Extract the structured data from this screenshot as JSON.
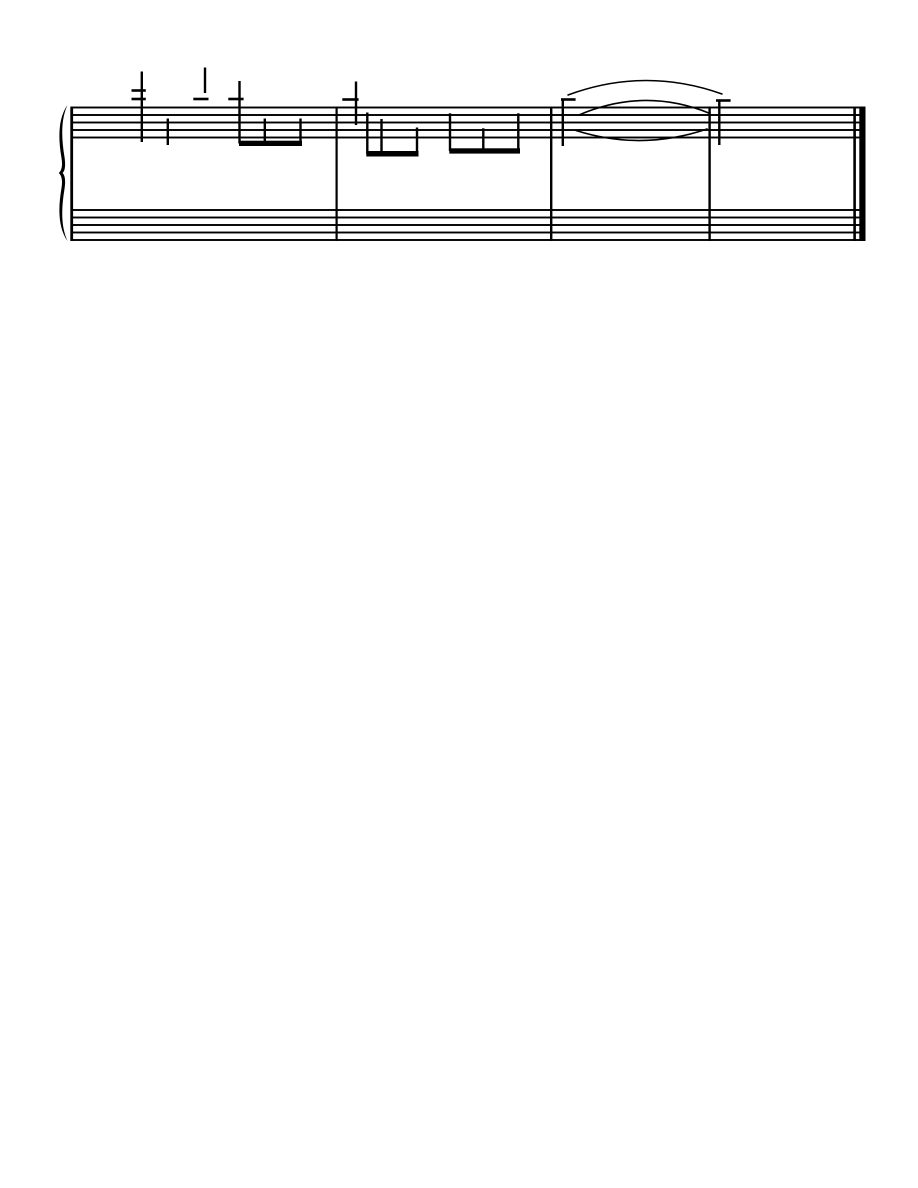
{
  "page": {
    "width": 918,
    "height": 1188,
    "background_color": "#ffffff",
    "ink_color": "#000000"
  },
  "system": {
    "staves": [
      {
        "name": "treble",
        "top": 107.5,
        "line_spacing": 7.5,
        "line_count": 5,
        "x1": 71,
        "x2": 865.5,
        "line_thickness": 1.9
      },
      {
        "name": "bass",
        "top": 210.0,
        "line_spacing": 7.5,
        "line_count": 5,
        "x1": 71,
        "x2": 865.5,
        "line_thickness": 1.9
      }
    ],
    "brace": {
      "path": "M 67.5 105 C 59 117, 57.5 135, 61.5 158 C 62.6 165, 62 170, 58.8 173 C 62 176, 62.6 181, 61.5 188 C 57.5 211, 59 229, 67.5 241 C 61.5 228, 60.8 211, 64.5 189 C 65.7 181, 65.2 175.6, 62.6 173 C 65.2 170.4, 65.7 165, 64.5 157 C 60.8 135, 61.5 118, 67.5 105 Z"
    },
    "barlines": [
      {
        "role": "system-start",
        "x": 70.3,
        "w": 2.8,
        "y1": 106.6,
        "y2": 241
      },
      {
        "role": "measure-1-end",
        "x": 335.5,
        "w": 2.2,
        "y1": 106.6,
        "y2": 241
      },
      {
        "role": "measure-2-end",
        "x": 550.0,
        "w": 2.4,
        "y1": 106.6,
        "y2": 241
      },
      {
        "role": "measure-3-end",
        "x": 708.4,
        "w": 2.4,
        "y1": 106.6,
        "y2": 241
      },
      {
        "role": "final-thin",
        "x": 853.3,
        "w": 2.6,
        "y1": 106.6,
        "y2": 241
      },
      {
        "role": "final-thick",
        "x": 859.3,
        "w": 6.2,
        "y1": 106.6,
        "y2": 241
      }
    ],
    "stems": [
      {
        "measure": 1,
        "x": 141.8,
        "y1": 71.5,
        "y2": 142,
        "w": 2.4
      },
      {
        "measure": 1,
        "x": 167.8,
        "y1": 118.5,
        "y2": 145,
        "w": 2.4
      },
      {
        "measure": 1,
        "x": 205.0,
        "y1": 67.5,
        "y2": 93,
        "w": 2.4
      },
      {
        "measure": 1,
        "x": 239.5,
        "y1": 81.0,
        "y2": 143.5,
        "w": 2.4
      },
      {
        "measure": 1,
        "x": 264.8,
        "y1": 118.5,
        "y2": 143.5,
        "w": 2.4
      },
      {
        "measure": 1,
        "x": 300.5,
        "y1": 118.5,
        "y2": 143.5,
        "w": 2.4
      },
      {
        "measure": 2,
        "x": 356.0,
        "y1": 81.5,
        "y2": 125,
        "w": 2.4
      },
      {
        "measure": 2,
        "x": 367.3,
        "y1": 112.5,
        "y2": 154,
        "w": 2.4
      },
      {
        "measure": 2,
        "x": 381.5,
        "y1": 119.0,
        "y2": 154,
        "w": 2.4
      },
      {
        "measure": 2,
        "x": 417.0,
        "y1": 127.5,
        "y2": 154,
        "w": 2.4
      },
      {
        "measure": 2,
        "x": 450.0,
        "y1": 113.3,
        "y2": 151,
        "w": 2.4
      },
      {
        "measure": 2,
        "x": 483.3,
        "y1": 128.3,
        "y2": 151,
        "w": 2.4
      },
      {
        "measure": 2,
        "x": 518.3,
        "y1": 113.3,
        "y2": 151,
        "w": 2.4
      },
      {
        "measure": 3,
        "x": 562.8,
        "y1": 99.5,
        "y2": 146,
        "w": 2.4
      },
      {
        "measure": 4,
        "x": 719.3,
        "y1": 101.0,
        "y2": 145,
        "w": 2.4
      }
    ],
    "ledger_lines": [
      {
        "x1": 131.5,
        "x2": 145.8,
        "y": 90.5,
        "h": 2.6
      },
      {
        "x1": 131.5,
        "x2": 145.8,
        "y": 99.0,
        "h": 2.6
      },
      {
        "x1": 193.3,
        "x2": 208.5,
        "y": 99.0,
        "h": 2.6
      },
      {
        "x1": 228.3,
        "x2": 243.6,
        "y": 99.0,
        "h": 2.6
      },
      {
        "x1": 342.3,
        "x2": 358.6,
        "y": 99.5,
        "h": 2.6
      },
      {
        "x1": 561.0,
        "x2": 575.6,
        "y": 99.5,
        "h": 2.6
      },
      {
        "x1": 716.0,
        "x2": 730.6,
        "y": 100.5,
        "h": 2.6
      }
    ],
    "beams": [
      {
        "x1": 239.0,
        "x2": 302.0,
        "y": 140.7,
        "h": 5.3
      },
      {
        "x1": 366.3,
        "x2": 418.5,
        "y": 151.0,
        "h": 5.5
      },
      {
        "x1": 449.3,
        "x2": 520.0,
        "y": 148.3,
        "h": 5.3
      }
    ],
    "ties": [
      {
        "role": "slur-above-staff",
        "x1": 568,
        "y1": 95.0,
        "cx": 645.0,
        "cy": 66.5,
        "x2": 722,
        "y2": 94.0,
        "stroke_width": 1.5
      },
      {
        "role": "tie-upper",
        "x1": 579,
        "y1": 115.0,
        "cx": 644.5,
        "cy": 86.75,
        "x2": 710,
        "y2": 113.5,
        "stroke_width": 1.6
      },
      {
        "role": "tie-lower",
        "x1": 576,
        "y1": 130.5,
        "cx": 641.5,
        "cy": 151.25,
        "x2": 707,
        "y2": 129.0,
        "stroke_width": 1.6
      }
    ]
  }
}
